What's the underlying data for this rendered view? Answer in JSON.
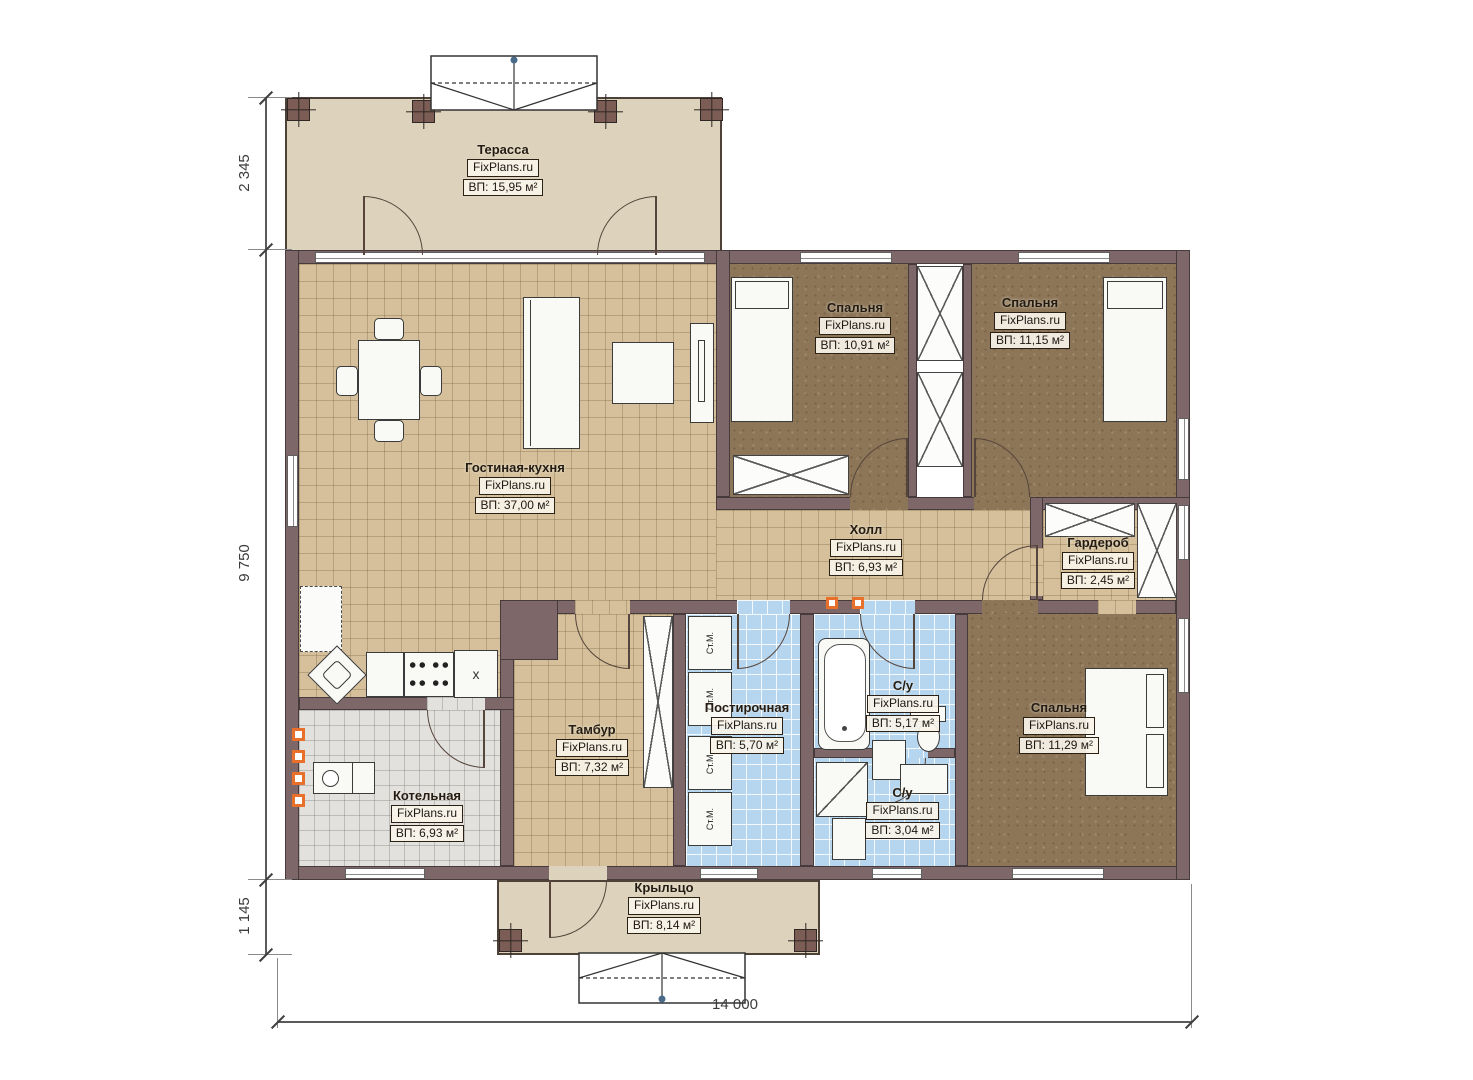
{
  "brand": "FixPlans.ru",
  "rooms": [
    {
      "name": "Терасса",
      "brand": "FixPlans.ru",
      "area": "ВП: 15,95 м²"
    },
    {
      "name": "Спальня",
      "brand": "FixPlans.ru",
      "area": "ВП: 10,91 м²"
    },
    {
      "name": "Спальня",
      "brand": "FixPlans.ru",
      "area": "ВП: 11,15 м²"
    },
    {
      "name": "Гостиная-кухня",
      "brand": "FixPlans.ru",
      "area": "ВП: 37,00 м²"
    },
    {
      "name": "Холл",
      "brand": "FixPlans.ru",
      "area": "ВП: 6,93 м²"
    },
    {
      "name": "Гардероб",
      "brand": "FixPlans.ru",
      "area": "ВП: 2,45 м²"
    },
    {
      "name": "Тамбур",
      "brand": "FixPlans.ru",
      "area": "ВП: 7,32 м²"
    },
    {
      "name": "Постирочная",
      "brand": "FixPlans.ru",
      "area": "ВП: 5,70 м²"
    },
    {
      "name": "С/у",
      "brand": "FixPlans.ru",
      "area": "ВП: 5,17 м²"
    },
    {
      "name": "Спальня",
      "brand": "FixPlans.ru",
      "area": "ВП: 11,29 м²"
    },
    {
      "name": "Котельная",
      "brand": "FixPlans.ru",
      "area": "ВП: 6,93 м²"
    },
    {
      "name": "С/у",
      "brand": "FixPlans.ru",
      "area": "ВП: 3,04 м²"
    },
    {
      "name": "Крыльцо",
      "brand": "FixPlans.ru",
      "area": "ВП: 8,14 м²"
    }
  ],
  "dimensions": {
    "left_top": "2 345",
    "left_middle": "9 750",
    "left_bottom": "1 145",
    "bottom": "14 000"
  },
  "appliances": {
    "washer_label": "Ст.М.",
    "fridge_mark": "x"
  },
  "colors": {
    "wall": "#7d6769",
    "floor_wood": "#d5c09b",
    "floor_bedroom": "#8d7557",
    "floor_wet": "#b6d5ef",
    "floor_boiler": "#e3e1dd",
    "terrace": "#ddd2bb",
    "accent_marker": "#e8702a"
  }
}
